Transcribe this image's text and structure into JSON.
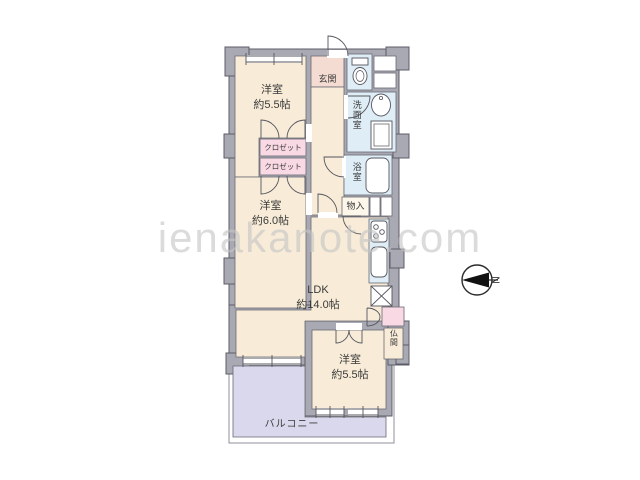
{
  "watermark": "ienakanote.com",
  "compass": {
    "label": "N"
  },
  "rooms": {
    "bedroom_top": {
      "name": "洋室",
      "size": "約5.5帖"
    },
    "closet1": {
      "name": "クロゼット"
    },
    "closet2": {
      "name": "クロゼット"
    },
    "bedroom_mid": {
      "name": "洋室",
      "size": "約6.0帖"
    },
    "entrance": {
      "name": "玄関"
    },
    "washroom": {
      "name": "洗面室"
    },
    "bathroom": {
      "name": "浴室"
    },
    "storage": {
      "name": "物入"
    },
    "ldk": {
      "name": "LDK",
      "size": "約14.0帖"
    },
    "butsuma": {
      "name": "仏間"
    },
    "bedroom_bottom": {
      "name": "洋室",
      "size": "約5.5帖"
    },
    "balcony": {
      "name": "バルコニー"
    }
  },
  "colors": {
    "wall": "#a9a9b3",
    "wall_line": "#5d5d68",
    "room_cream": "#f8ecd8",
    "closet_pink": "#f9d9e3",
    "entrance_pink": "#f5dcd2",
    "water_blue": "#dfeef6",
    "balcony_lavender": "#d9d8ec",
    "text": "#3a3a3a",
    "watermark_gray": "#c6c6c6"
  }
}
